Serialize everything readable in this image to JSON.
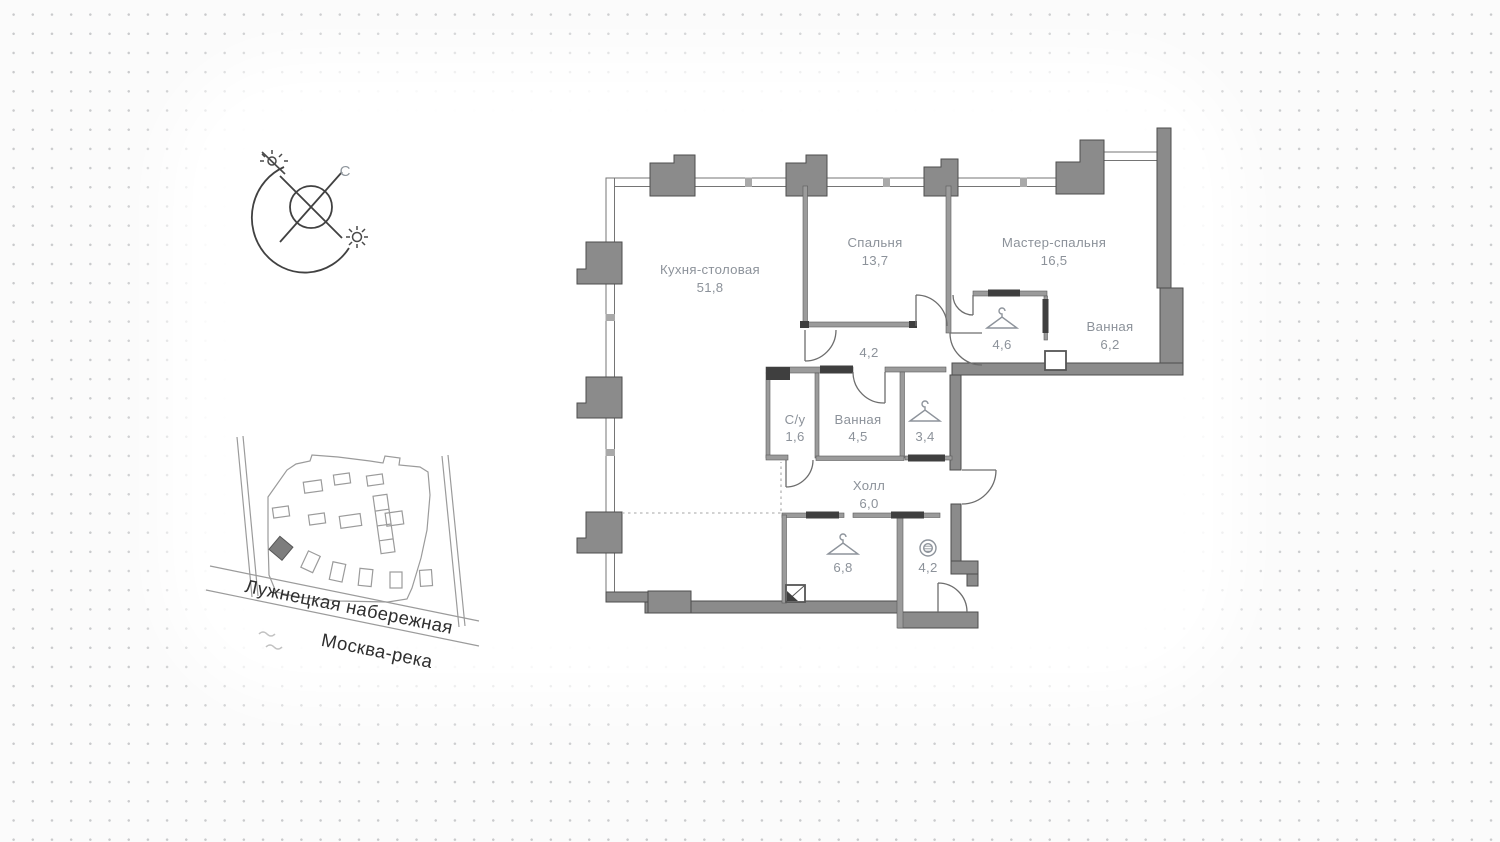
{
  "page": {
    "background": "#fbfbfb",
    "dot_color": "#c9cacc",
    "wall_color": "#8b8b8b",
    "wall_dark_color": "#3f3f3f",
    "room_label_color": "#8c929a",
    "map_text_color": "#2f2f2f"
  },
  "compass": {
    "north_label": "С",
    "icons": [
      "sun-icon",
      "no-sun-icon",
      "north-arc"
    ]
  },
  "site_plan": {
    "street_label": "Лужнецкая набережная",
    "river_label": "Москва-река",
    "highlighted_building": "dark-diamond"
  },
  "floor_plan": {
    "rooms": {
      "kitchen": {
        "name": "Кухня-столовая",
        "area": "51,8"
      },
      "bedroom": {
        "name": "Спальня",
        "area": "13,7"
      },
      "master_bedroom": {
        "name": "Мастер-спальня",
        "area": "16,5"
      },
      "bathroom_master": {
        "name": "Ванная",
        "area": "6,2"
      },
      "wardrobe_master": {
        "name": "",
        "area": "4,6",
        "icon": "hanger-icon"
      },
      "corridor": {
        "name": "",
        "area": "4,2"
      },
      "wc": {
        "name": "С/у",
        "area": "1,6"
      },
      "bathroom": {
        "name": "Ванная",
        "area": "4,5"
      },
      "closet": {
        "name": "",
        "area": "3,4",
        "icon": "hanger-icon"
      },
      "hall": {
        "name": "Холл",
        "area": "6,0"
      },
      "wardrobe_hall": {
        "name": "",
        "area": "6,8",
        "icon": "hanger-icon"
      },
      "laundry": {
        "name": "",
        "area": "4,2",
        "icon": "washing-machine-icon"
      }
    }
  }
}
